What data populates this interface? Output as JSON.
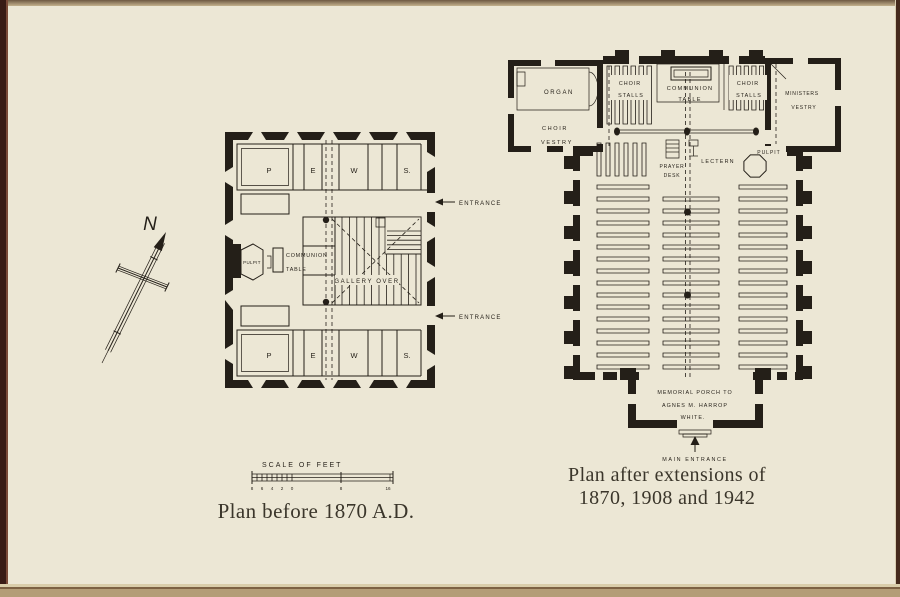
{
  "page": {
    "paper_color": "#ece7d5",
    "ink_color": "#241f18"
  },
  "compass": {
    "north": "N"
  },
  "scale_bar": {
    "title": "SCALE OF FEET",
    "ticks_left": [
      "8",
      "6",
      "4",
      "2",
      "0"
    ],
    "tick_mid": "8",
    "tick_right": "16"
  },
  "plan_before": {
    "caption": "Plan before 1870 A.D.",
    "pews_top": [
      "P",
      "E",
      "W",
      "S."
    ],
    "pews_bottom": [
      "P",
      "E",
      "W",
      "S."
    ],
    "pulpit": "PULPIT",
    "communion": [
      "COMMUNION",
      "TABLE"
    ],
    "gallery": "GALLERY OVER",
    "entrance_upper": "ENTRANCE",
    "entrance_lower": "ENTRANCE"
  },
  "plan_after": {
    "caption": [
      "Plan after extensions of",
      "1870, 1908 and 1942"
    ],
    "organ": "ORGAN",
    "choir_vestry": [
      "CHOIR",
      "VESTRY"
    ],
    "choir_stalls_left": [
      "CHOIR",
      "STALLS"
    ],
    "communion_table": [
      "COMMUNION",
      "TABLE"
    ],
    "choir_stalls_right": [
      "CHOIR",
      "STALLS"
    ],
    "ministers_vestry": [
      "MINISTERS",
      "VESTRY"
    ],
    "prayer_desk": [
      "PRAYER",
      "DESK"
    ],
    "lectern": "LECTERN",
    "pulpit": "PULPIT",
    "porch": [
      "MEMORIAL PORCH TO",
      "AGNES M. HARROP",
      "WHITE."
    ],
    "main_entrance": "MAIN ENTRANCE"
  }
}
